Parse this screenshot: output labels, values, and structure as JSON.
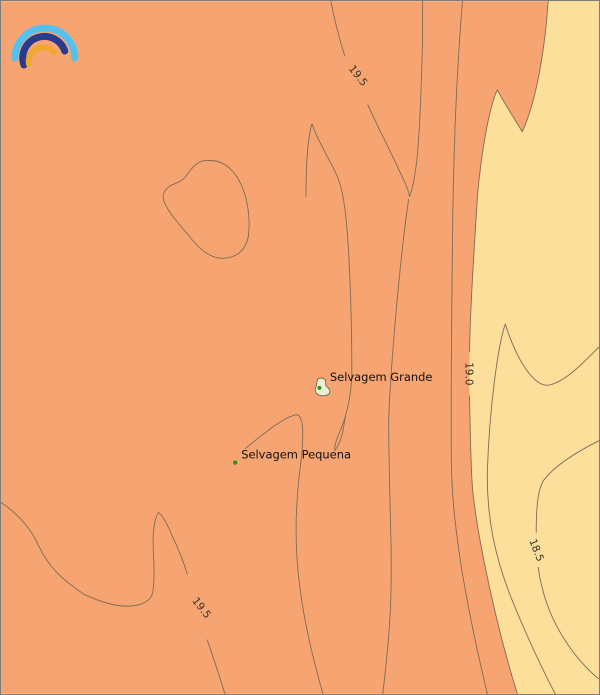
{
  "map": {
    "colors": {
      "sea_warm": "#f6a471",
      "sea_cool": "#fbdf9b",
      "contour_line": "#7e6c55",
      "border": "#7d7d7d",
      "place_label_text": "#121212",
      "contour_label_text": "#3a332a",
      "island_fill": "#f0eed2",
      "island_outline": "#55624d",
      "marker_green": "#17a317"
    },
    "places": [
      {
        "name": "Selvagem Grande"
      },
      {
        "name": "Selvagem Pequena"
      }
    ],
    "contour_labels": [
      {
        "value": "19.5",
        "position": "top"
      },
      {
        "value": "19.0",
        "position": "right-edge-of-warm-band"
      },
      {
        "value": "18.5",
        "position": "bottom-right"
      },
      {
        "value": "19.5",
        "position": "bottom-left"
      }
    ],
    "logo": {
      "name": "rainbow-arcs-logo",
      "arc_colors": [
        "#55c1ee",
        "#2a3a8c",
        "#f0a832"
      ]
    }
  },
  "chart_data": {
    "type": "contour-map",
    "contour_levels_labeled": [
      18.5,
      19.0,
      19.5
    ],
    "fill_bands": [
      {
        "band": "left/warm side of 19.0 line",
        "color": "#f6a471"
      },
      {
        "band": "right/cool side of 19.0 line",
        "color": "#fbdf9b"
      }
    ],
    "labeled_points": [
      {
        "name": "Selvagem Grande",
        "marker": "small island polygon with green dot",
        "approx_px": [
          322,
          387
        ]
      },
      {
        "name": "Selvagem Pequena",
        "marker": "green dot",
        "approx_px": [
          235,
          463
        ]
      }
    ]
  }
}
